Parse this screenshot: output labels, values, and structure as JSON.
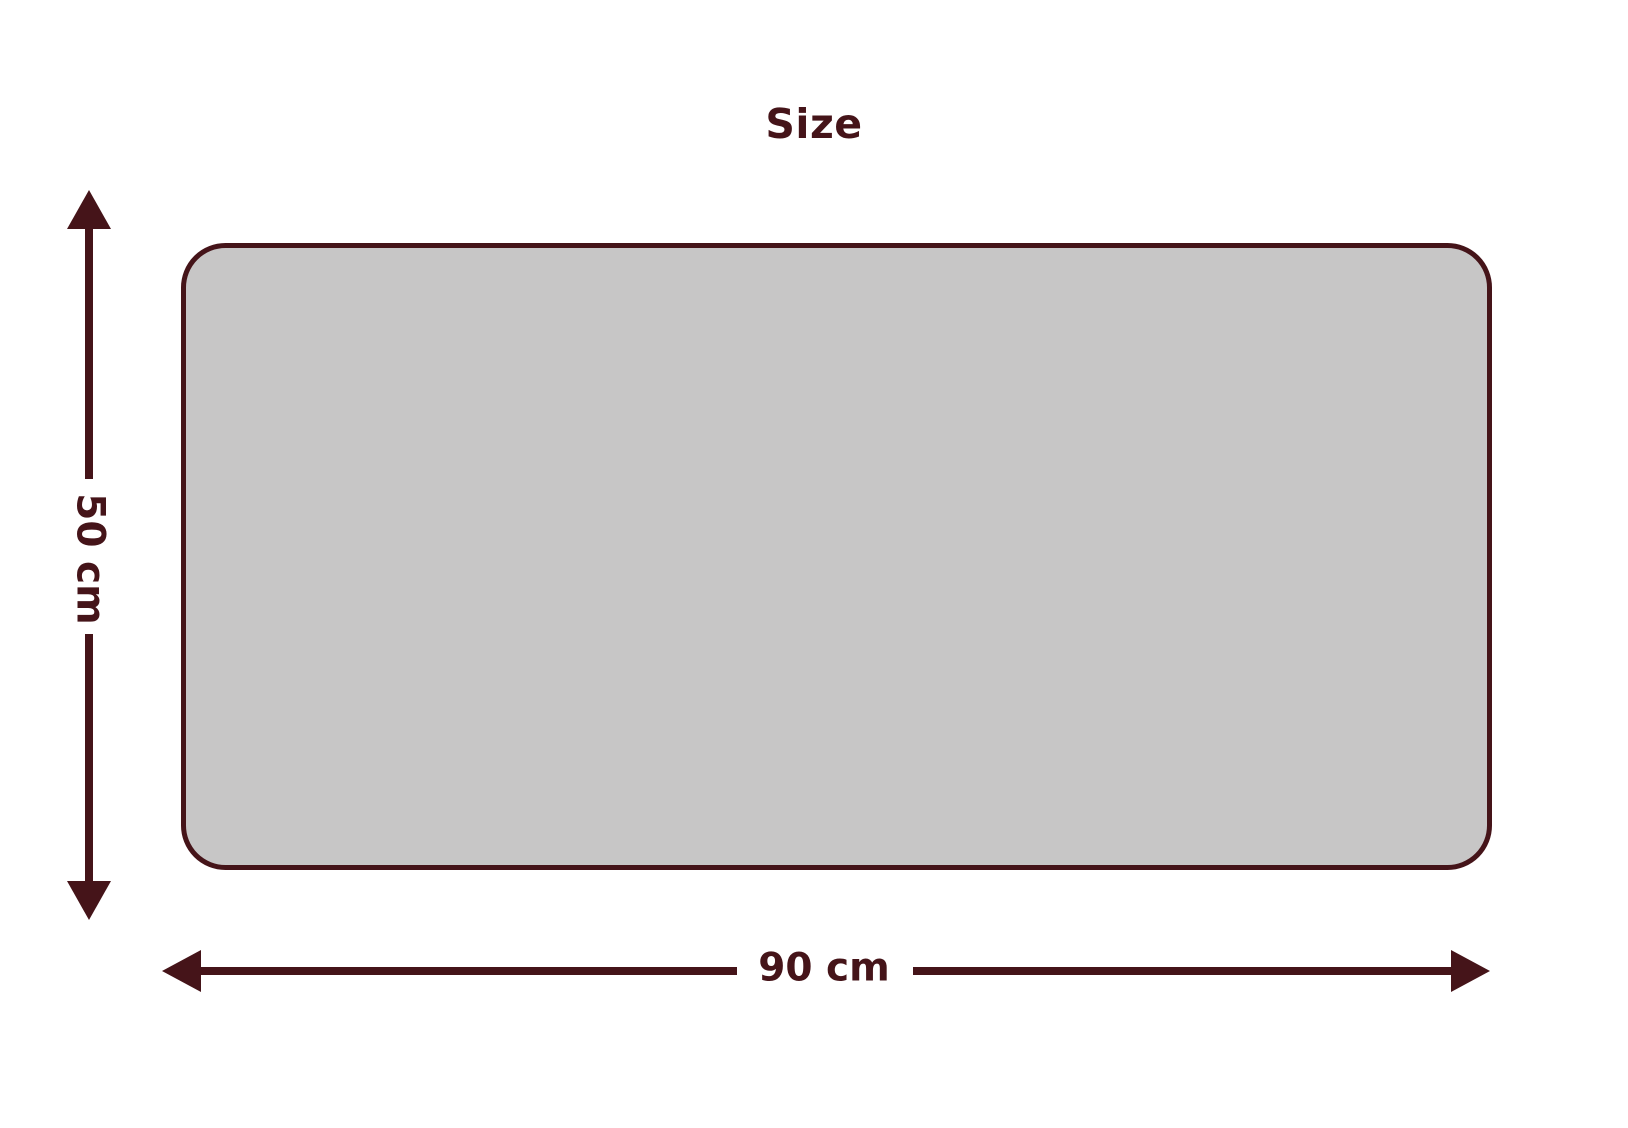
{
  "title": "Size",
  "dimensions": {
    "height_label": "50 cm",
    "width_label": "90 cm"
  },
  "colors": {
    "accent": "#451419",
    "panel_fill": "#c7c6c6",
    "background": "#ffffff"
  }
}
